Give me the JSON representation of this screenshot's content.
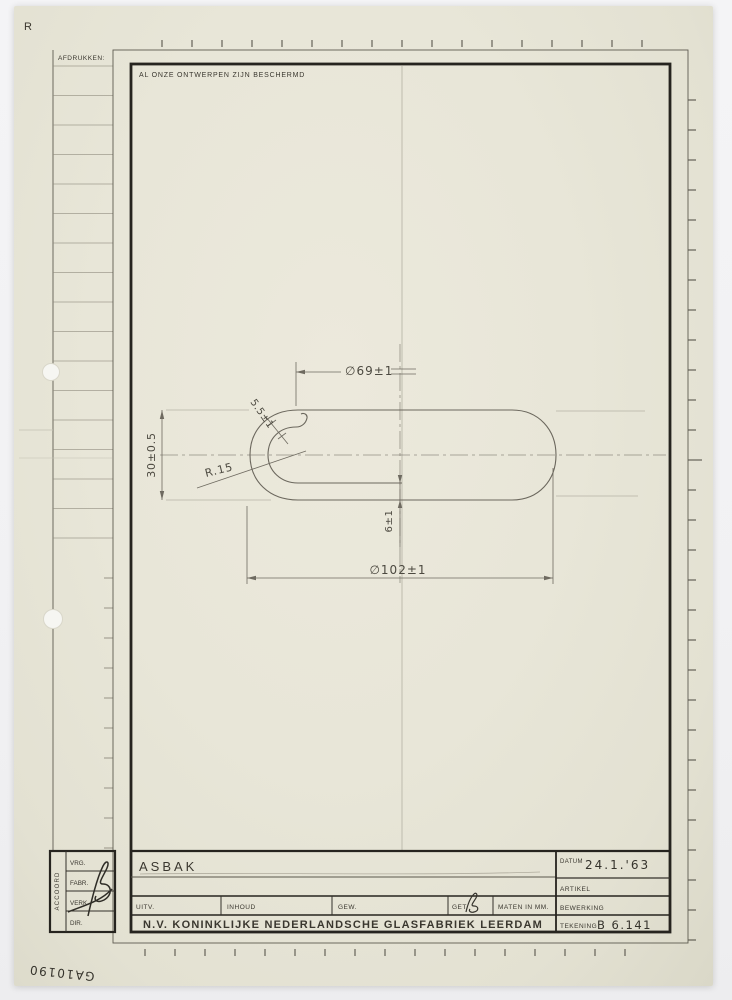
{
  "page": {
    "corner_stamp": "R",
    "archive_code": "GA10190",
    "colors": {
      "paper": "#e8e6d8",
      "ink": "#2b2924",
      "pencil": "#6e6a60"
    }
  },
  "margin_column": {
    "header": "AFDRUKKEN:"
  },
  "drawing": {
    "protection_notice": "AL ONZE ONTWERPEN ZIJN BESCHERMD",
    "dimensions": {
      "top_diameter": "∅69±1",
      "overall_height": "30±0.5",
      "rim_thickness": "5.5±1",
      "rim_radius": "R.15",
      "base_thickness": "6±1",
      "outer_diameter": "∅102±1"
    }
  },
  "approval_block": {
    "vertical_label": "ACCOORD",
    "rows": [
      "VRG.",
      "FABR.",
      "VERK.",
      "DIR."
    ],
    "signature": "B"
  },
  "title_block": {
    "title": "ASBAK",
    "labels": {
      "uitv": "UITV.",
      "inhoud": "INHOUD",
      "gew": "GEW.",
      "get": "GET.",
      "maten": "MATEN IN MM.",
      "datum": "DATUM",
      "artikel": "ARTIKEL",
      "bewerking": "BEWERKING",
      "tekening": "TEKENING"
    },
    "values": {
      "datum": "24.1.'63",
      "tekening": "B 6.141",
      "get_signature": "B",
      "artikel": "",
      "bewerking": ""
    },
    "company": "N.V. KONINKLIJKE NEDERLANDSCHE GLASFABRIEK LEERDAM"
  }
}
